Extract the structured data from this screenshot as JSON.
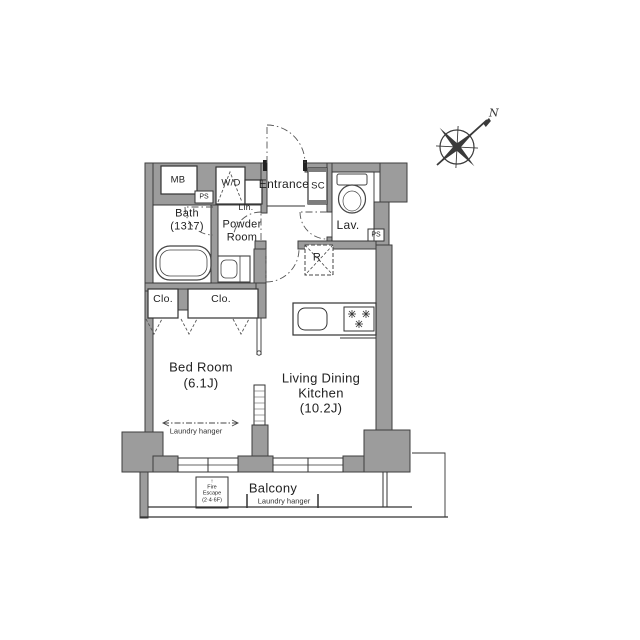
{
  "plan": {
    "title": "1LDK apartment floor plan",
    "labels": {
      "entrance": "Entrance",
      "shoe_closet": "SC",
      "lavatory": "Lav.",
      "washer_dryer": "W/D",
      "linen": "Lin.",
      "powder_room": [
        "Powder",
        "Room"
      ],
      "bath": [
        "Bath",
        "(1317)"
      ],
      "meter_box": "MB",
      "pipe_space": "PS",
      "refrigerator": "R",
      "closet": "Clo.",
      "bedroom": [
        "Bed Room",
        "(6.1J)"
      ],
      "ldk": [
        "Living Dining",
        "Kitchen",
        "(10.2J)"
      ],
      "balcony": "Balcony",
      "laundry_hanger": "Laundry hanger",
      "fire_escape": {
        "arrow": "↑",
        "lines": [
          "Fire",
          "Escape",
          "(2·4·6F)"
        ]
      },
      "compass_north": "N"
    },
    "colors": {
      "wall": "#9c9c9c",
      "line": "#3a3a3a",
      "background": "#ffffff"
    }
  }
}
